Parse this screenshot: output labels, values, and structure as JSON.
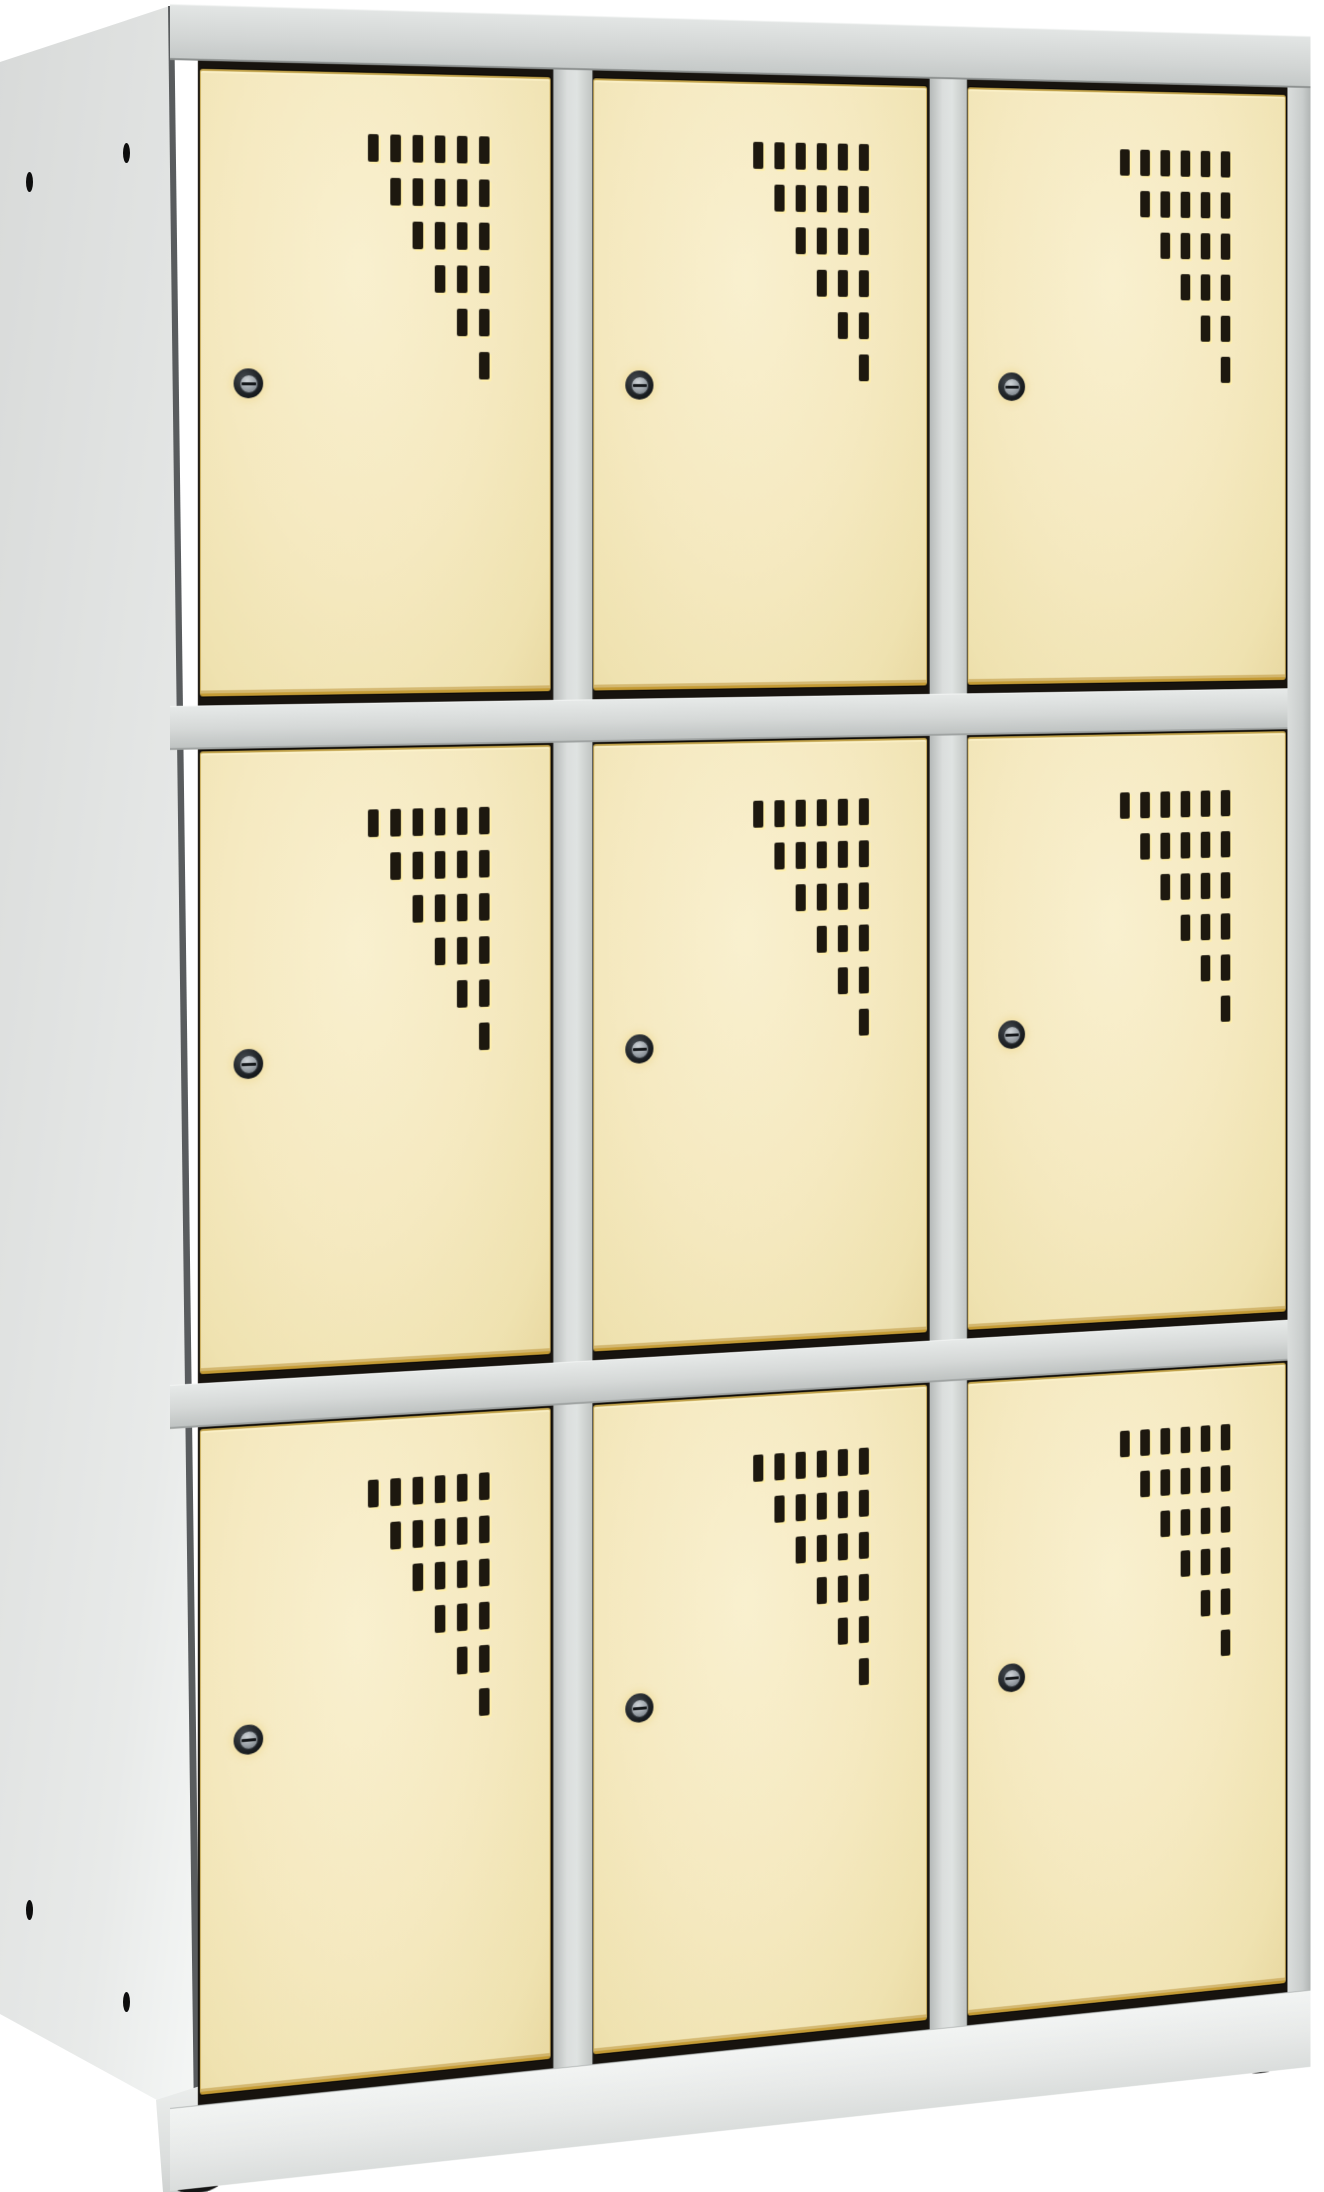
{
  "scene": {
    "type": "product-photo",
    "subject": "Metal locker cabinet with nine compartments in a 3x3 grid, cream doors with punched ventilation slots and round cylinder locks, light grey steel body, viewed from the front-left on a plain white background",
    "background_color": "#ffffff"
  },
  "locker": {
    "rows": 3,
    "columns": 3,
    "compartment_count": 9,
    "body_color": "#e4e6e5",
    "frame_color": "#d5d8d7",
    "plinth_color": "#eef0ef",
    "door_color": "#f4e8bf",
    "door_color_name": "cream",
    "door_edge_highlight": "#d9b545",
    "door_gap_color": "#16120c",
    "vent_slot_color": "#1d180f",
    "vents_per_door": 21,
    "vent_pattern": {
      "rows": 6,
      "slots_in_first_row": 6,
      "step": "each lower row drops its leftmost slot, forming a descending staircase"
    },
    "locks_per_door": 1,
    "lock": {
      "style": "round cylinder lock with horizontal key slit",
      "ring_color": "#1a1d20",
      "face_color": "#9aa0a6",
      "position": "near left edge, mid-height of door"
    },
    "feet_visible": 2,
    "foot_color": "#141414",
    "side_screw_holes_visible": 4
  }
}
